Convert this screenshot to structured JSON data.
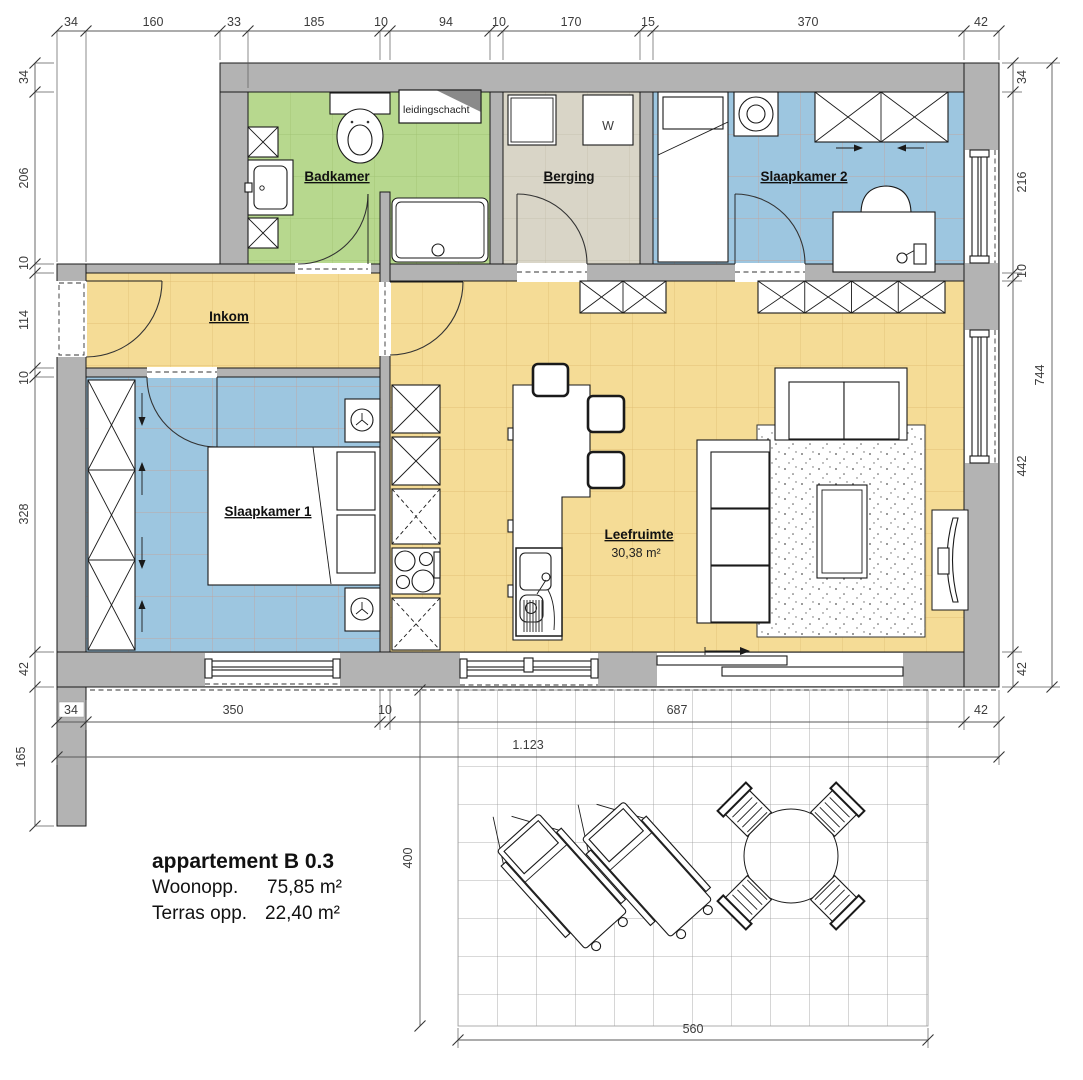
{
  "title_block": {
    "title": "appartement B 0.3",
    "line1_label": "Woonopp.",
    "line1_value": "75,85 m²",
    "line2_label": "Terras opp.",
    "line2_value": "22,40 m²"
  },
  "rooms": {
    "badkamer": {
      "label": "Badkamer"
    },
    "berging": {
      "label": "Berging"
    },
    "slaapkamer2": {
      "label": "Slaapkamer 2"
    },
    "inkom": {
      "label": "Inkom"
    },
    "slaapkamer1": {
      "label": "Slaapkamer 1"
    },
    "leefruimte": {
      "label": "Leefruimte",
      "area": "30,38 m²"
    }
  },
  "annotations": {
    "duct": "leidingschacht",
    "washer": "W"
  },
  "dims": {
    "top": [
      "34",
      "160",
      "33",
      "185",
      "10",
      "94",
      "10",
      "170",
      "15",
      "370",
      "42"
    ],
    "left": [
      "34",
      "206",
      "10",
      "114",
      "10",
      "328",
      "42"
    ],
    "right": [
      "34",
      "216",
      "10",
      "442",
      "42"
    ],
    "right_total": "744",
    "bottom": [
      "34",
      "350",
      "10",
      "687",
      "42"
    ],
    "bottom_total": "1.123",
    "left_below": "165",
    "terrace_depth": "400",
    "terrace_width": "560"
  },
  "colors": {
    "wall": "#b3b3b3",
    "bathroom": "#b7d88e",
    "storage": "#d9d5c7",
    "bedroom": "#9dc6e0",
    "living": "#f5dc96"
  }
}
